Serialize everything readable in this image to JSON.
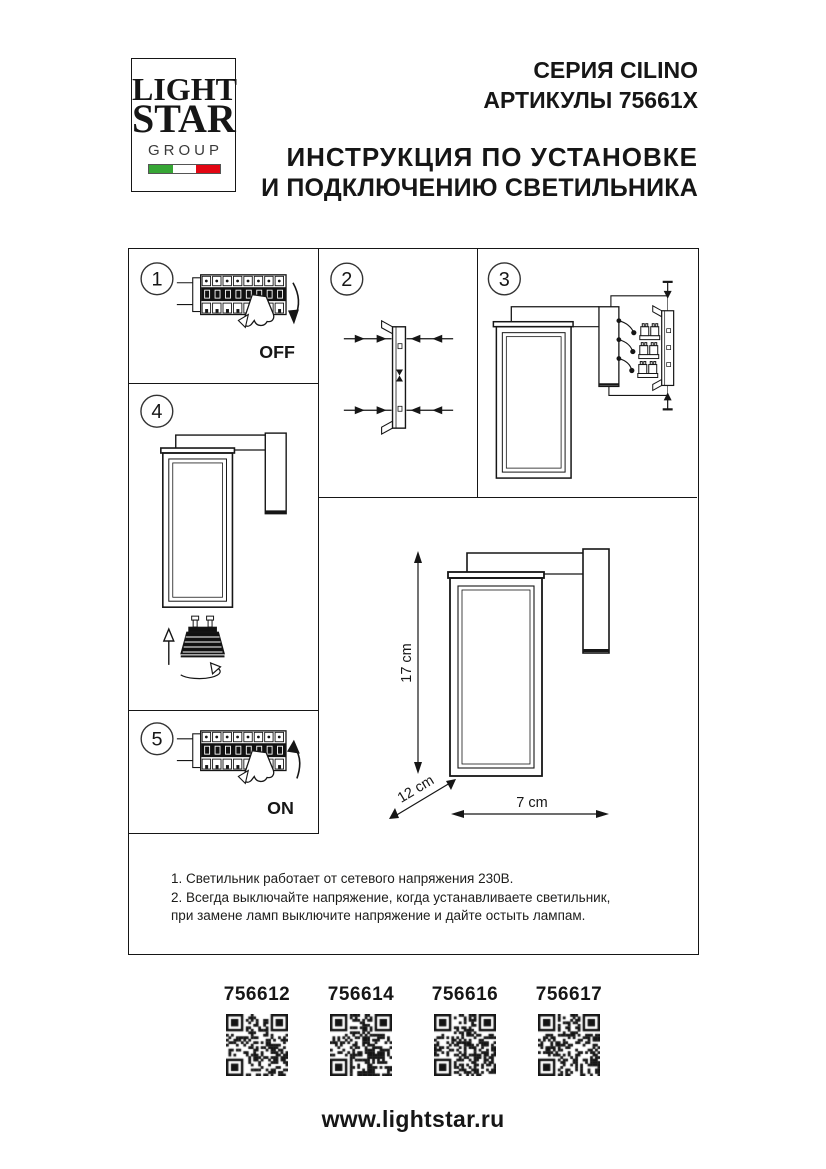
{
  "header": {
    "logo": {
      "line1": "LIGHT",
      "line2": "STAR",
      "line3": "GROUP"
    },
    "series": "СЕРИЯ CILINO",
    "articles": "АРТИКУЛЫ 75661X",
    "instruction_line1": "ИНСТРУКЦИЯ ПО УСТАНОВКЕ",
    "instruction_line2": "И ПОДКЛЮЧЕНИЮ СВЕТИЛЬНИКА"
  },
  "diagram": {
    "steps": [
      {
        "number": "1",
        "label": "OFF"
      },
      {
        "number": "2",
        "label": ""
      },
      {
        "number": "3",
        "label": ""
      },
      {
        "number": "4",
        "label": ""
      },
      {
        "number": "5",
        "label": "ON"
      }
    ],
    "dimensions": {
      "height": "17 cm",
      "depth": "12 cm",
      "width": "7 cm"
    },
    "notes": [
      "1. Светильник работает от сетевого напряжения 230В.",
      "2. Всегда выключайте напряжение, когда устанавливаете светильник,",
      "при замене ламп выключите напряжение и дайте остыть лампам."
    ]
  },
  "footer": {
    "qr_codes": [
      {
        "label": "756612"
      },
      {
        "label": "756614"
      },
      {
        "label": "756616"
      },
      {
        "label": "756617"
      }
    ],
    "website": "www.lightstar.ru"
  },
  "colors": {
    "ink": "#161616",
    "flag_green": "#36a635",
    "flag_white": "#ffffff",
    "flag_red": "#e30613"
  }
}
